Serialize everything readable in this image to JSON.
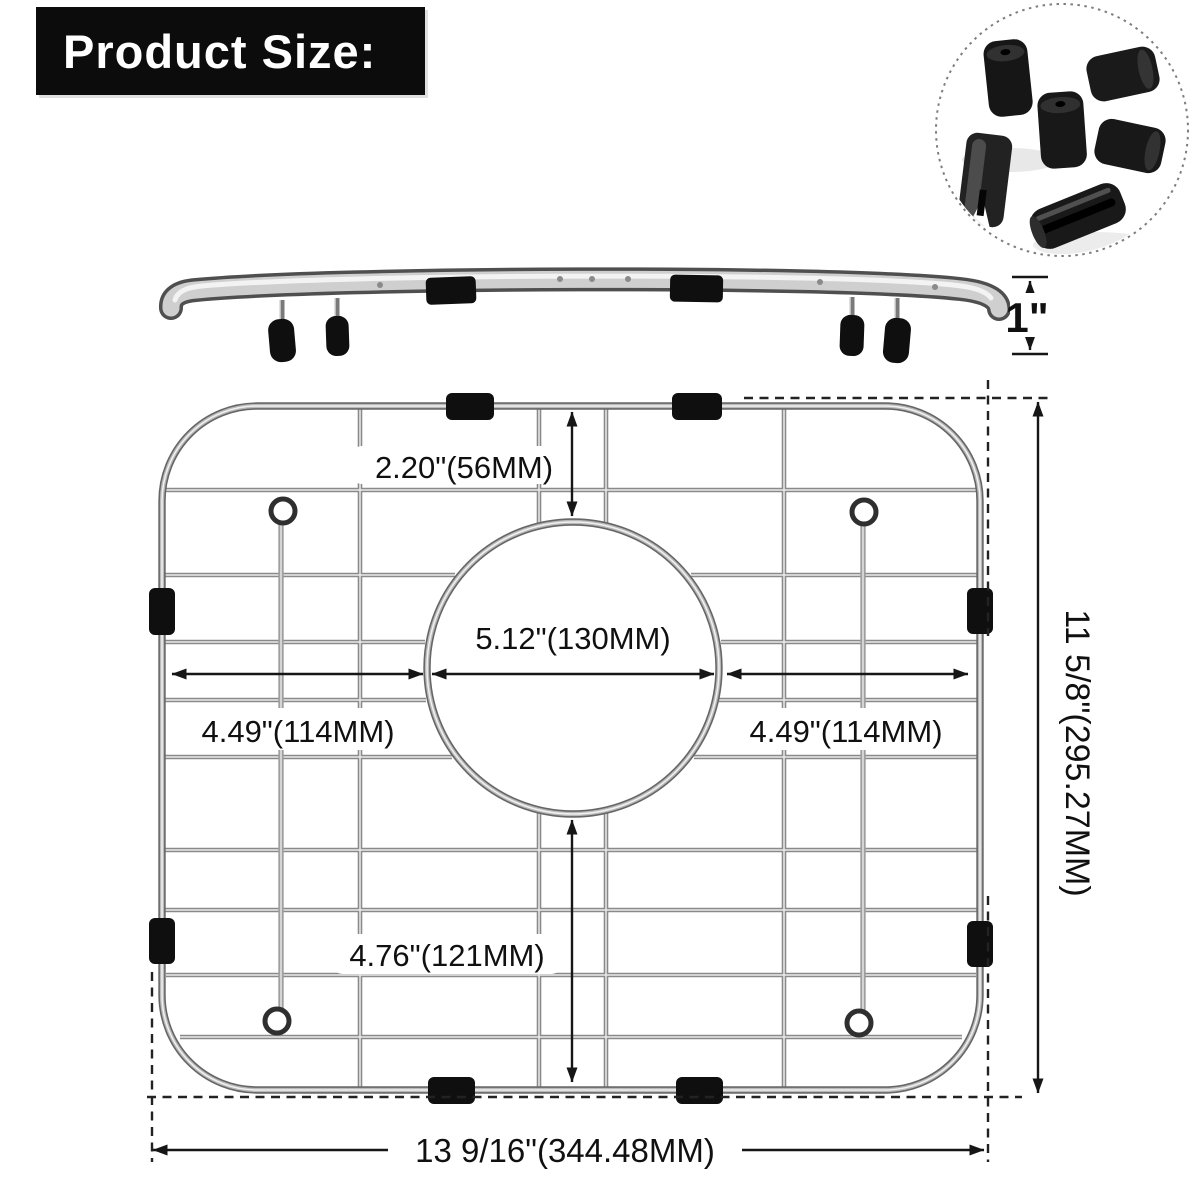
{
  "header": {
    "title": "Product Size:"
  },
  "side_view": {
    "height_label": "1\""
  },
  "top_view": {
    "top_to_hole_label": "2.20\"(56MM)",
    "hole_diameter_label": "5.12\"(130MM)",
    "left_to_hole_label": "4.49\"(114MM)",
    "hole_to_right_label": "4.49\"(114MM)",
    "bottom_to_hole_label": "4.76\"(121MM)",
    "overall_height_label": "11 5/8\"(295.27MM)",
    "overall_width_label": "13 9/16\"(344.48MM)"
  },
  "icons": {
    "feet_photo": "rubber-feet-and-clips-photo"
  },
  "colors": {
    "banner_bg": "#0c0c0c",
    "banner_text": "#ffffff",
    "dimension_line": "#161616",
    "wire_chrome": "#8d8d8d",
    "bumper_black": "#0f0f0f"
  }
}
